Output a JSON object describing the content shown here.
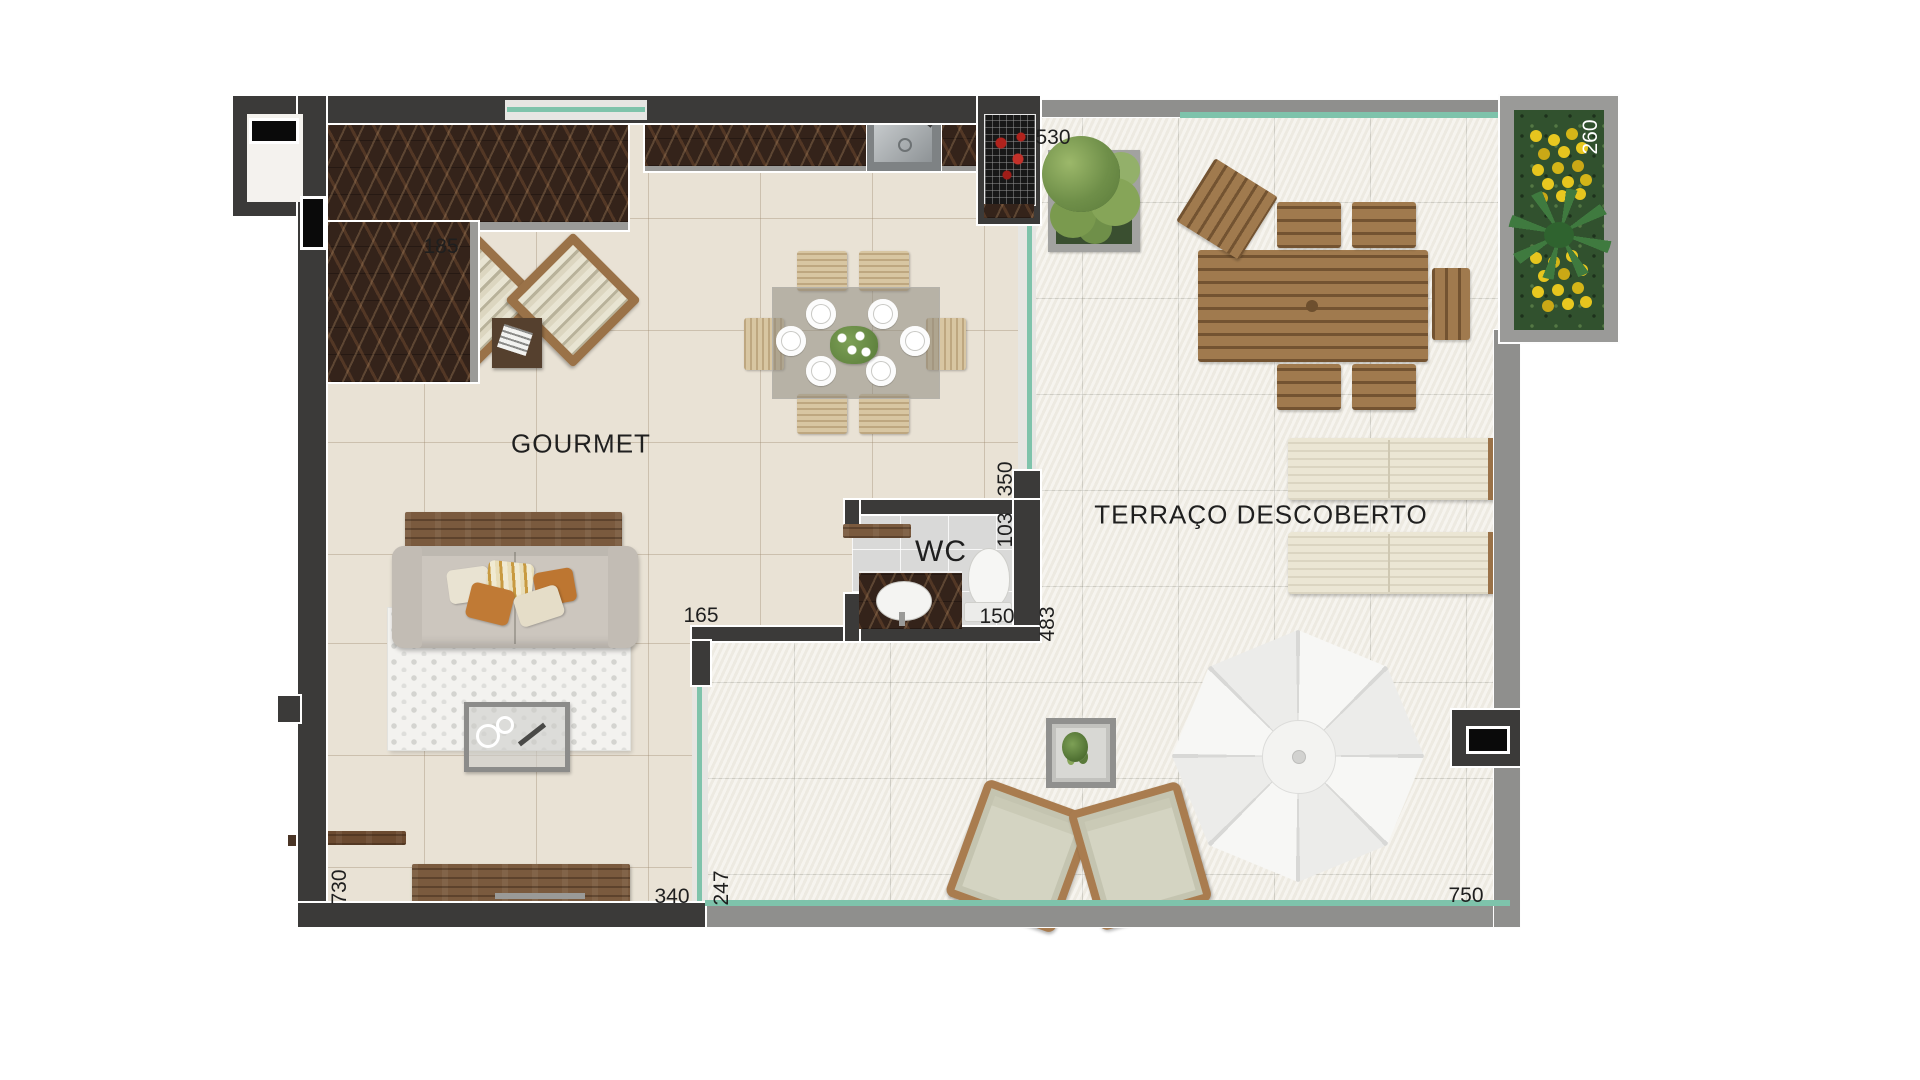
{
  "rooms": {
    "gourmet": {
      "label": "GOURMET"
    },
    "wc": {
      "label": "WC"
    },
    "terrace": {
      "label": "TERRAÇO DESCOBERTO"
    }
  },
  "dimensions_cm": {
    "gourmet_counter": "185",
    "terrace_top_width": "530",
    "garden_depth": "260",
    "partition_upper": "350",
    "wc_door": "103",
    "inner_wall": "165",
    "wc_width": "150",
    "wc_outer_side": "483",
    "gourmet_left_depth": "730",
    "gourmet_bottom_width": "340",
    "partition_lower": "247",
    "terrace_bottom_width": "750"
  },
  "colors": {
    "wall_dark": "#3b3a39",
    "wall_concrete": "#8f8f8d",
    "glass": "#7ec3ab",
    "floor_gourmet": "#e9e2d5",
    "floor_terrace": "#f1eee6",
    "floor_wc": "#d9d9d8",
    "marble_counter": "#34231a",
    "wood": "#7a5a3e",
    "teak_outdoor": "#a07a4e",
    "flower_yellow": "#e6c51e",
    "plant_green": "#6f8f49",
    "label_text": "#1f1f1f",
    "garden_label_text": "#ffffff"
  },
  "furniture": [
    "kitchen-sink",
    "barbecue-grill",
    "l-shaped-counter",
    "lounge-armchair",
    "side-table",
    "dining-table-glass",
    "wicker-chair",
    "sofa",
    "console-table",
    "rug",
    "coffee-table",
    "tv-sideboard",
    "wall-shelf",
    "wc-vanity",
    "wc-sink",
    "toilet",
    "planter-tree",
    "outdoor-dining-table",
    "outdoor-chair",
    "sun-lounger",
    "parasol-umbrella",
    "outdoor-armchair",
    "small-planter",
    "flower-bed",
    "palm-plant"
  ]
}
